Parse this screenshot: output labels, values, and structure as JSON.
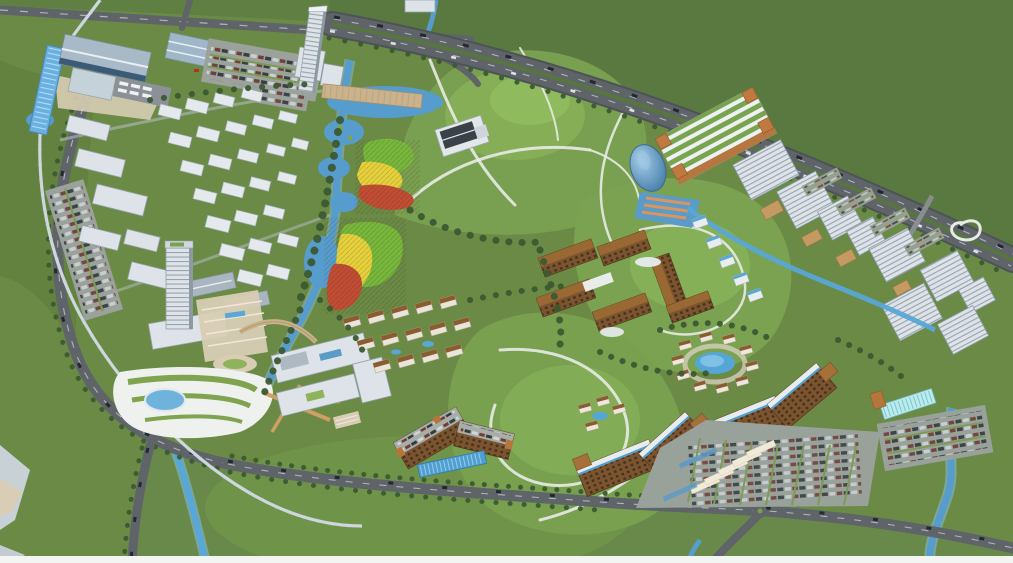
{
  "image": {
    "kind": "3d-aerial-masterplan-rendering",
    "description": "Bird's-eye architectural rendering of a hillside campus masterplan: a transit station and white town blocks in the north-west, two slender landmark towers, lakes with terraced gardens striped in green, yellow and red, grassy hills laced with winding white trails, brown courtyard buildings, villa clusters with pools, long brown dormitory slabs with large car parks in the south, a stepped row of white offices along a motorway to the east, all surrounded by open farmland and tree-lined ring roads",
    "palette": {
      "farmland_dark": "#5a7941",
      "farmland": "#6a8a46",
      "campus_lawn": "#70934a",
      "hill": "#79a050",
      "hill_crown": "#86b058",
      "trail_white": "#e7ebe6",
      "road_gray": "#5e6468",
      "water_blue": "#569ccd",
      "water_light": "#8fc3e0",
      "white_building": "#dde3e8",
      "building_shade": "#96a2ac",
      "glass_blue": "#58a7d6",
      "brown_facade": "#7b5430",
      "brown_roof": "#9a6832",
      "terrace_green": "#76b73c",
      "terrace_yellow": "#e5d13c",
      "terrace_red": "#c04d34",
      "tree_green": "#3c5a31",
      "plaza_tan": "#d8cdb4",
      "bottom_border": "#f3f5f3"
    },
    "features": [
      {
        "name": "transit-station",
        "detail": "long blue glass platform roof, gabled terminal hall, bus depot and car parks"
      },
      {
        "name": "north-west-town-cluster",
        "detail": "grid of white low-rise blocks among trees"
      },
      {
        "name": "landmark-tower-north",
        "detail": "slender white high-rise by the motorway with lakeside boardwalk pier"
      },
      {
        "name": "landmark-tower-south",
        "detail": "white tower with podium, stepped tan plaza and arched footbridge"
      },
      {
        "name": "terraced-gardens",
        "detail": "two striped planting fields coloured green, yellow and red beside ponds"
      },
      {
        "name": "central-hills",
        "detail": "grassy knolls with winding white trails and a single dark-roofed hilltop pavilion"
      },
      {
        "name": "courtyard-campus-cluster",
        "detail": "brown mid-rise blocks with pitched roofs and white canopies"
      },
      {
        "name": "villa-clusters",
        "detail": "small white villas ringing swimming pools"
      },
      {
        "name": "dormitory-slabs",
        "detail": "two bent brown residential slabs with white-and-blue striped rooflines"
      },
      {
        "name": "south-parking-lots",
        "detail": "large surface car parks with planting strips and white shelters"
      },
      {
        "name": "east-office-row",
        "detail": "stepped white office blocks, low tan-roofed courts and a canal"
      },
      {
        "name": "green-roof-hall",
        "detail": "long hall with striped planted roof and orange corner towers"
      },
      {
        "name": "blue-glass-dome",
        "detail": "curved blue glass pavilion on a blue plaza with orange stripes"
      },
      {
        "name": "motorway",
        "detail": "multi-lane highway sweeping along the north-east edge"
      },
      {
        "name": "ring-boulevards",
        "detail": "tree-lined roads encircling the site with traffic"
      },
      {
        "name": "monorail-line",
        "detail": "elevated guideway threading from the station through the park"
      },
      {
        "name": "lakes-and-streams",
        "detail": "chain of ponds, a meandering river and canals"
      },
      {
        "name": "landscaped-park",
        "detail": "swirling white garden paths around an oval pond"
      },
      {
        "name": "farmland",
        "detail": "open green fields framing the development"
      }
    ]
  }
}
